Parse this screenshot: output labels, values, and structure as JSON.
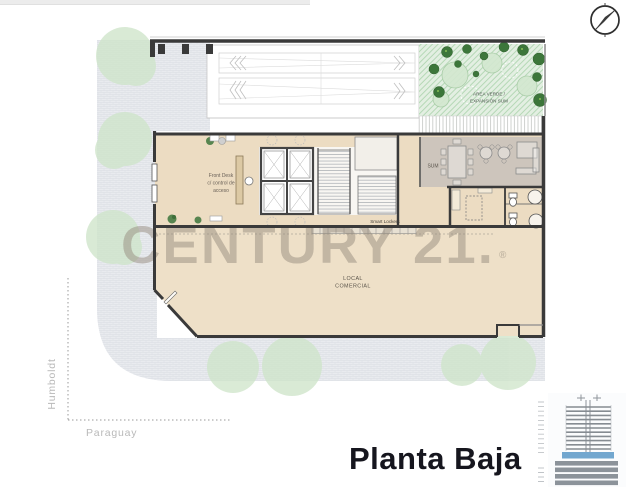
{
  "title": "Planta Baja",
  "watermark": {
    "text": "CENTURY 21.",
    "registered": "®"
  },
  "streets": {
    "left": "Humboldt",
    "bottom": "Paraguay"
  },
  "rooms": {
    "front_desk": [
      "Front Desk",
      "c/ control de",
      "acceso"
    ],
    "sum": "SUM",
    "smart_lockers": "Smart Lockers",
    "local_comercial": [
      "LOCAL",
      "COMERCIAL"
    ],
    "area_verde": [
      "AREA VERDE /",
      "EXPANSIÓN SUM"
    ]
  },
  "colors": {
    "floor_tan": "#ecdcc2",
    "local_floor": "#eee0c8",
    "sum_floor": "#cdc5bc",
    "wall_dark": "#3a3a3a",
    "sidewalk": "#e9ebef",
    "tree_green": "#cfe5ca",
    "green_area": "#e3efe2",
    "dark_tree": "#3c763a",
    "highlight_blue": "#72a7cf",
    "title_color": "#16161e",
    "watermark_gray": "#93887a"
  }
}
